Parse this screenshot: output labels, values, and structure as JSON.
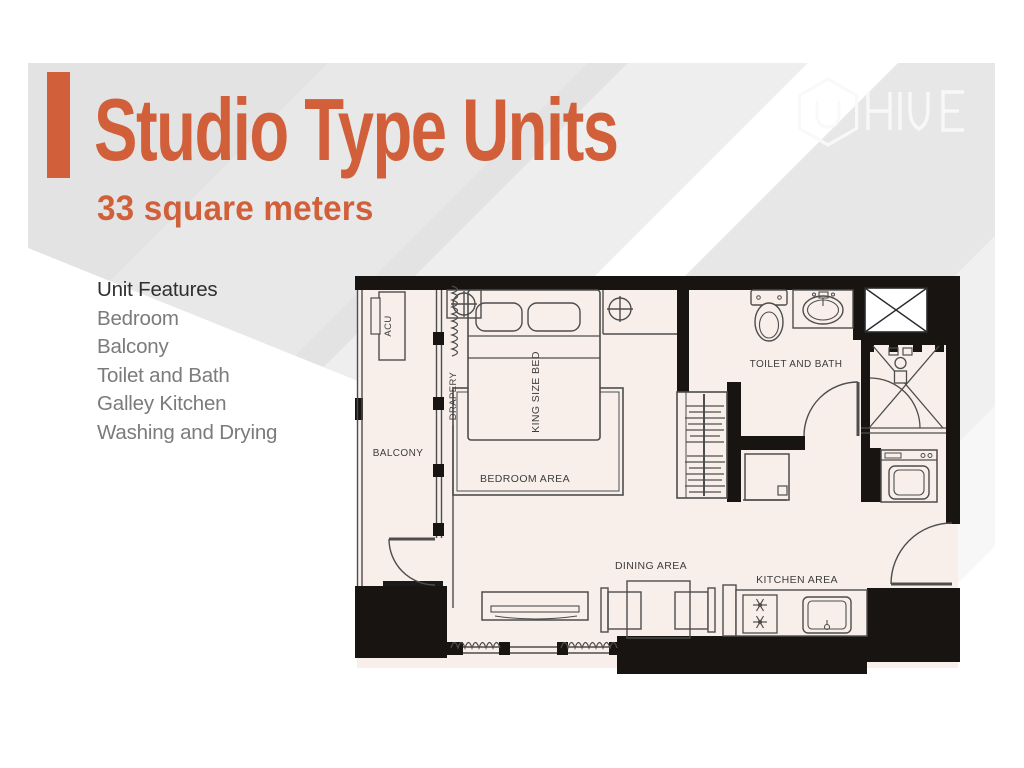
{
  "slide": {
    "title": "Studio Type Units",
    "subtitle": "33 square meters",
    "features": {
      "heading": "Unit Features",
      "items": [
        "Bedroom",
        "Balcony",
        "Toilet and Bath",
        "Galley Kitchen",
        "Washing and Drying"
      ]
    },
    "logo": {
      "brand": "HIVE"
    },
    "floor_plan": {
      "labels": {
        "acu": "ACU",
        "drapery": "DRAPERY",
        "balcony": "BALCONY",
        "king_size_bed": "KING SIZE BED",
        "bedroom_area": "BEDROOM AREA",
        "toilet_and_bath": "TOILET AND BATH",
        "dining_area": "DINING AREA",
        "kitchen_area": "KITCHEN AREA"
      }
    },
    "colors": {
      "accent_orange": "#d15f3a",
      "heading_text": "#2f2f2f",
      "feature_text": "#7b7b7b",
      "plan_floor": "#f8efeb",
      "plan_wall": "#171412",
      "plan_line": "#4d4d4d"
    }
  }
}
